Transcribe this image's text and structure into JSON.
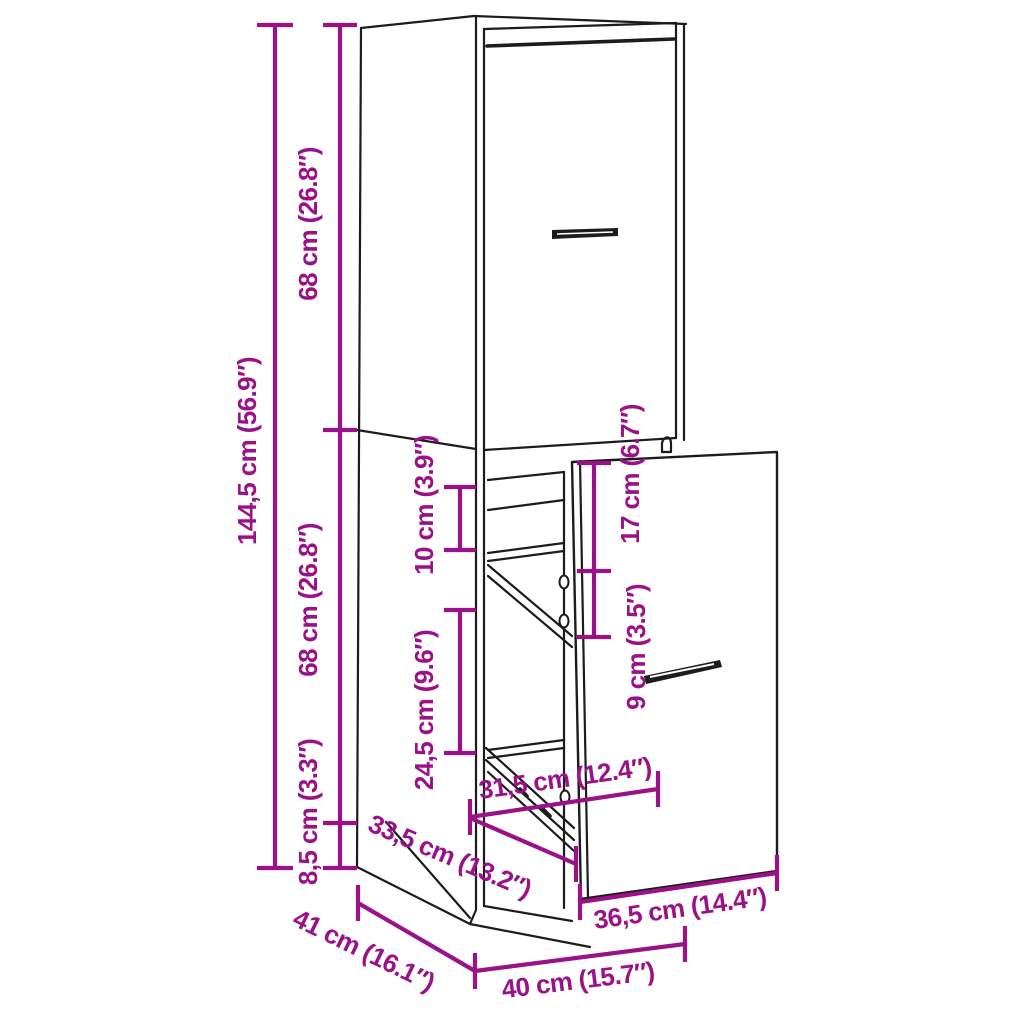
{
  "title": "Apothecary cabinet with pull-out drawer — dimension diagram",
  "colors": {
    "dimension": "#9a1188",
    "line": "#1c1c1c",
    "background": "#ffffff"
  },
  "dimensions": {
    "total_height": {
      "label": "144,5 cm (56.9″)"
    },
    "upper_section_height": {
      "label": "68 cm (26.8″)"
    },
    "lower_section_height": {
      "label": "68 cm (26.8″)"
    },
    "base_height": {
      "label": "8,5 cm (3.3″)"
    },
    "top_shelf_gap": {
      "label": "10 cm (3.9″)"
    },
    "drawer_top_inset": {
      "label": "17 cm (6.7″)"
    },
    "lower_shelf_gap": {
      "label": "24,5 cm (9.6″)"
    },
    "handle_inset": {
      "label": "9 cm (3.5″)"
    },
    "inner_width": {
      "label": "31,5 cm (12.4″)"
    },
    "drawer_extension": {
      "label": "33,5 cm (13.2″)"
    },
    "drawer_front_width": {
      "label": "36,5 cm (14.4″)"
    },
    "depth": {
      "label": "41 cm (16.1″)"
    },
    "width": {
      "label": "40 cm (15.7″)"
    }
  }
}
